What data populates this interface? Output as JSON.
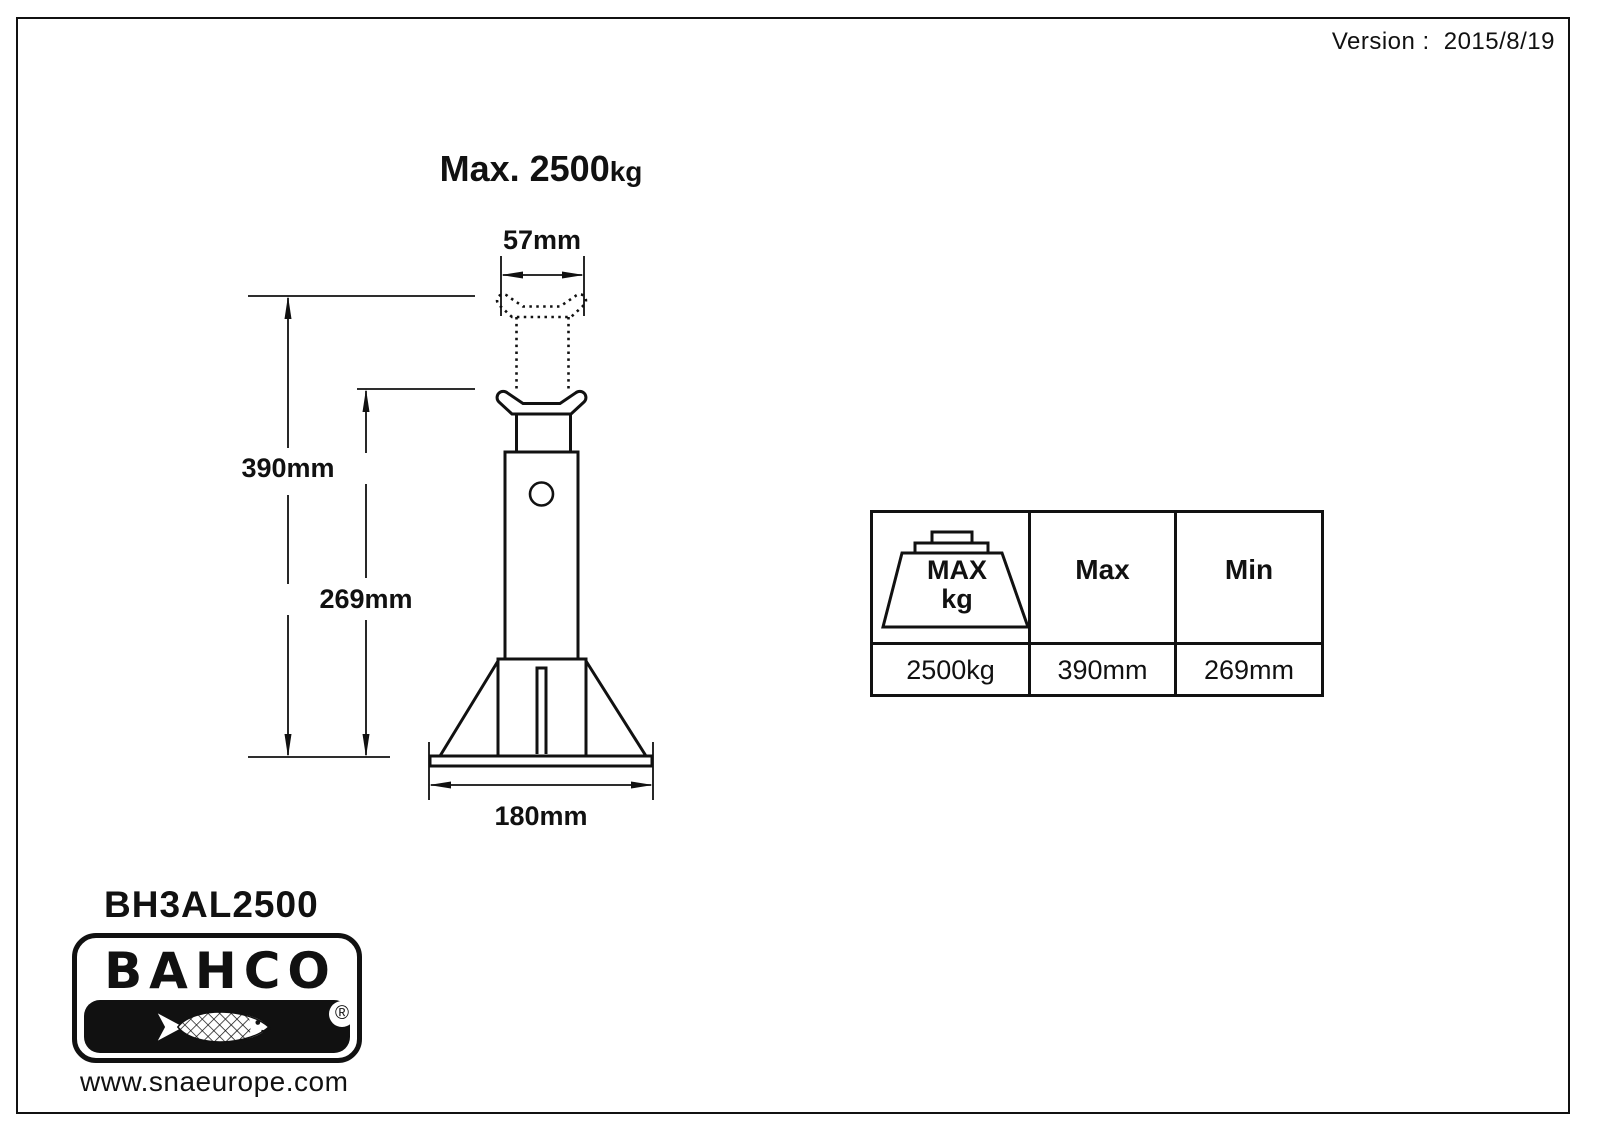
{
  "page": {
    "version_label": "Version :",
    "version_value": "2015/8/19"
  },
  "drawing": {
    "title_main": "Max. 2500",
    "title_unit": "kg",
    "dim_top_width": "57mm",
    "dim_max_height": "390mm",
    "dim_min_height": "269mm",
    "dim_base_width": "180mm"
  },
  "spec_table": {
    "weight_icon_line1": "MAX",
    "weight_icon_line2": "kg",
    "col_max_label": "Max",
    "col_min_label": "Min",
    "value_capacity": "2500kg",
    "value_max_height": "390mm",
    "value_min_height": "269mm"
  },
  "footer": {
    "model": "BH3AL2500",
    "brand": "BAHCO",
    "registered_mark": "®",
    "website": "www.snaeurope.com"
  },
  "colors": {
    "ink": "#111111",
    "background": "#ffffff"
  }
}
